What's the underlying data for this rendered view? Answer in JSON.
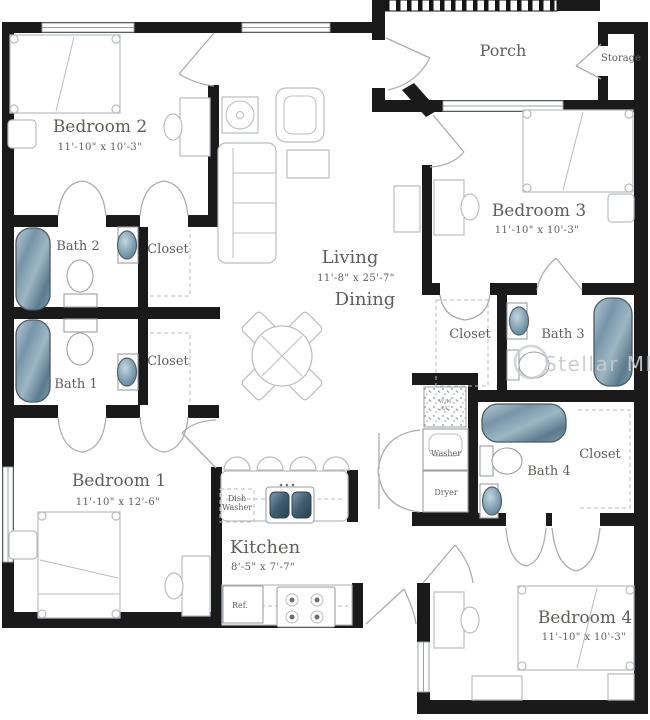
{
  "colors": {
    "wall": "#1a1a1a",
    "furniture": "#b9bdc3",
    "label": "#5f5e5a",
    "watermark": "#c7cbcf",
    "water_light": "#aec6d3",
    "water_dark": "#5c7b8e"
  },
  "watermark": "Stellar MLS",
  "rooms": {
    "bedroom1": {
      "label": "Bedroom 1",
      "dims": "11'-10\" x 12'-6\""
    },
    "bedroom2": {
      "label": "Bedroom 2",
      "dims": "11'-10\" x 10'-3\""
    },
    "bedroom3": {
      "label": "Bedroom 3",
      "dims": "11'-10\" x 10'-3\""
    },
    "bedroom4": {
      "label": "Bedroom 4",
      "dims": "11'-10\" x 10'-3\""
    },
    "living": {
      "label": "Living",
      "dims": "11'-8\" x 25'-7\"",
      "label2": "Dining"
    },
    "kitchen": {
      "label": "Kitchen",
      "dims": "8'-5\" x 7'-7\""
    },
    "porch": {
      "label": "Porch"
    },
    "storage": {
      "label": "Storage"
    },
    "bath1": {
      "label": "Bath 1"
    },
    "bath2": {
      "label": "Bath 2"
    },
    "bath3": {
      "label": "Bath 3"
    },
    "bath4": {
      "label": "Bath 4"
    },
    "closets": {
      "bedroom2": "Closet",
      "bedroom1": "Closet",
      "bath3": "Closet",
      "bath4": "Closet"
    }
  },
  "appliances": {
    "washer": "Washer",
    "dryer": "Dryer",
    "dishwasher1": "Dish",
    "dishwasher2": "Washer",
    "ref": "Ref.",
    "water_heater": "W/H",
    "ac": "A/C"
  }
}
